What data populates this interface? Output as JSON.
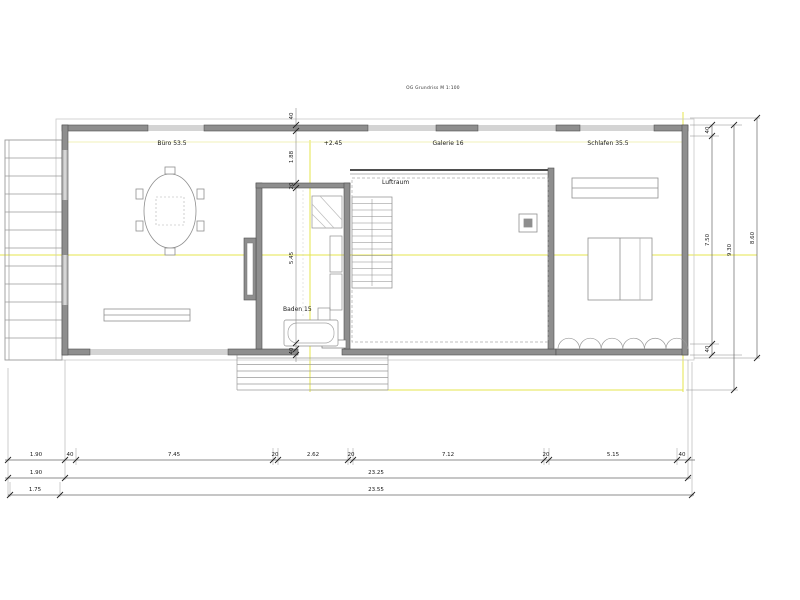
{
  "drawing": {
    "title": "OG Grundriss M 1:100"
  },
  "rooms": {
    "buero": "Büro 53.5",
    "level": "+2.45",
    "galerie": "Galerie 16",
    "schlafen": "Schlafen 35.5",
    "luftraum": "Luftraum",
    "baden": "Baden 15"
  },
  "dims": {
    "vertical_mid": [
      "40",
      "1.88",
      "20",
      "5.45",
      "40"
    ],
    "right": {
      "wall_top": "40",
      "inner": "7.50",
      "wall_bottom": "40",
      "overall": "9.30",
      "outer": "8.60"
    },
    "bottom_row1": [
      "1.90",
      "40",
      "7.45",
      "20",
      "2.62",
      "20",
      "7.12",
      "20",
      "5.15",
      "40"
    ],
    "bottom_row2": [
      "1.90",
      "23.25"
    ],
    "bottom_row3": [
      "1.75",
      "23.55"
    ]
  },
  "colors": {
    "wall": "#8e8e8e",
    "line": "#5a5a5a",
    "construction_yellow": "#e4e44e",
    "dim_text": "#1a1a1a"
  }
}
